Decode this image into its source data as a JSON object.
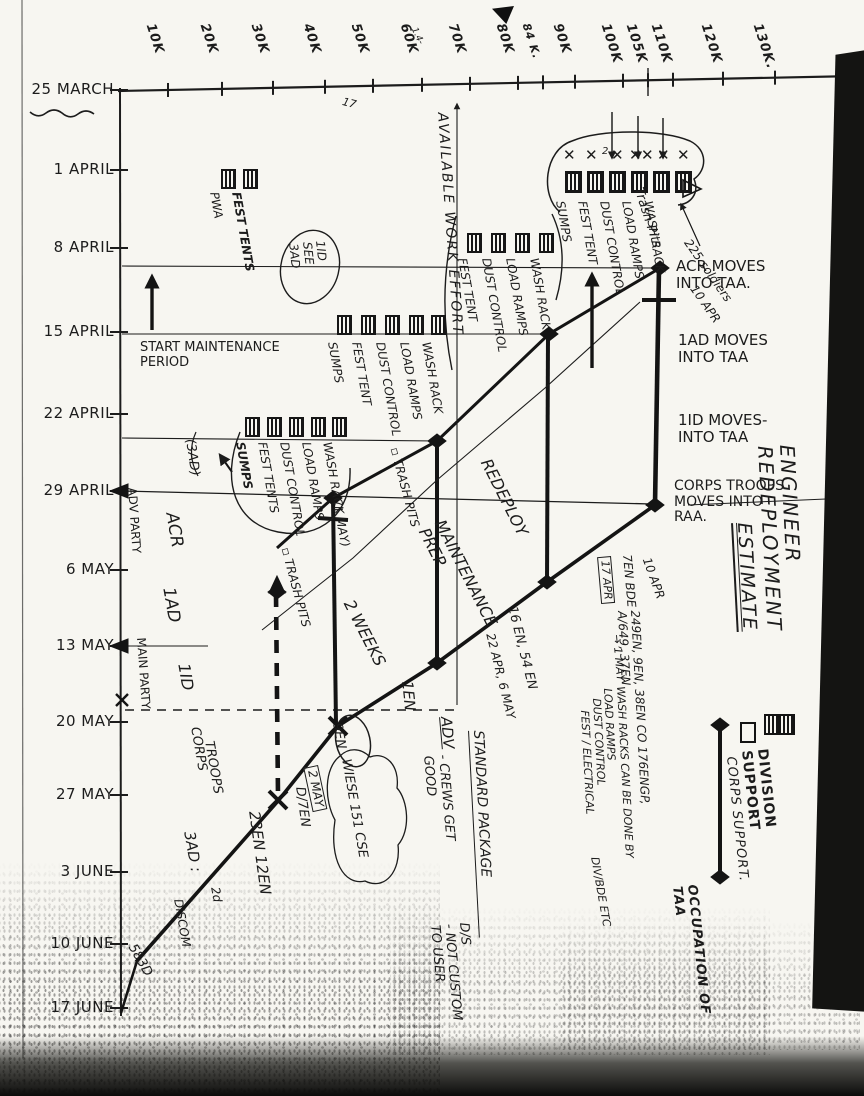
{
  "title": {
    "line1": "ENGINEER REDEPLOYMENT",
    "line2": "ESTIMATE"
  },
  "axes": {
    "date_ticks": [
      "25 MARCH",
      "1 APRIL",
      "8 APRIL",
      "15 APRIL",
      "22 APRIL",
      "29 APRIL",
      "6 MAY",
      "13 MAY",
      "20 MAY",
      "27 MAY",
      "3 JUNE",
      "10 JUNE",
      "17 JUNE"
    ],
    "km_ticks": [
      {
        "t": "10K"
      },
      {
        "t": "20K"
      },
      {
        "t": "30K"
      },
      {
        "t": "40K"
      },
      {
        "t": "50K"
      },
      {
        "t": "60K"
      },
      {
        "t": "70K"
      },
      {
        "t": "80K"
      },
      {
        "t": "84 K.",
        "small": true
      },
      {
        "t": "90K"
      },
      {
        "t": "100K"
      },
      {
        "t": "105K"
      },
      {
        "t": "110K"
      },
      {
        "t": "120K"
      },
      {
        "t": "130K."
      }
    ]
  },
  "legend": {
    "items": [
      {
        "symbol": "division-support-boxes",
        "label": "DIVISION SUPPORT"
      },
      {
        "symbol": "corps-support-box",
        "label": "CORPS SUPPORT."
      },
      {
        "symbol": "occupation-bar",
        "label": "OCCUPATION OF TAA"
      }
    ]
  },
  "annotations": [
    {
      "n": "acr-moves-note",
      "t": "ACR MOVES\nINTO TAA.",
      "x": 676,
      "y": 258,
      "r": 0,
      "fs": 15
    },
    {
      "n": "1ad-moves-note",
      "t": "1AD MOVES\nINTO TAA",
      "x": 678,
      "y": 332,
      "r": 0,
      "fs": 15
    },
    {
      "n": "1id-moves-note",
      "t": "1ID MOVES-\nINTO TAA",
      "x": 678,
      "y": 412,
      "r": 0,
      "fs": 15
    },
    {
      "n": "corps-troops-note",
      "t": "CORPS TROOPS\nMOVES INTO\nRAA.",
      "x": 674,
      "y": 479,
      "r": 0,
      "fs": 14
    },
    {
      "n": "start-maintenance-note",
      "t": "START MAINTENANCE\nPERIOD",
      "x": 140,
      "y": 341,
      "r": 0,
      "fs": 13
    },
    {
      "n": "available-work-effort",
      "t": "AVAILABLE  WORK  EFFORT",
      "x": 449,
      "y": 112,
      "r": 86,
      "fs": 14,
      "i": 1,
      "ls": 2
    },
    {
      "n": "maintenance-prep",
      "t": "MAINTENANCE\nPREP",
      "x": 447,
      "y": 517,
      "r": 63,
      "fs": 16,
      "i": 1
    },
    {
      "n": "redeploy",
      "t": "REDEPLOY",
      "x": 493,
      "y": 456,
      "r": 63,
      "fs": 16,
      "i": 1
    },
    {
      "n": "two-weeks",
      "t": "2 WEEKS",
      "x": 356,
      "y": 597,
      "r": 63,
      "fs": 16,
      "i": 1
    },
    {
      "n": "adv-party",
      "t": "ADV PARTY",
      "x": 138,
      "y": 487,
      "r": 86,
      "fs": 12
    },
    {
      "n": "main-party",
      "t": "MAIN PARTY",
      "x": 147,
      "y": 637,
      "r": 86,
      "fs": 12
    },
    {
      "n": "col-acr",
      "t": "ACR",
      "x": 180,
      "y": 511,
      "r": 80,
      "fs": 17,
      "i": 1
    },
    {
      "n": "col-1ad",
      "t": "1AD",
      "x": 177,
      "y": 586,
      "r": 80,
      "fs": 17,
      "i": 1
    },
    {
      "n": "col-1id",
      "t": "1ID",
      "x": 192,
      "y": 662,
      "r": 80,
      "fs": 16,
      "i": 1
    },
    {
      "n": "col-corps",
      "t": "CORPS",
      "x": 201,
      "y": 726,
      "r": 80,
      "fs": 13,
      "i": 1
    },
    {
      "n": "col-troops",
      "t": "TROOPS",
      "x": 215,
      "y": 740,
      "r": 80,
      "fs": 13,
      "i": 1
    },
    {
      "n": "col-3ad",
      "t": "3AD :",
      "x": 197,
      "y": 830,
      "r": 80,
      "fs": 15,
      "i": 1
    },
    {
      "n": "col-2d",
      "t": "2d",
      "x": 221,
      "y": 886,
      "r": 80,
      "fs": 12,
      "i": 1
    },
    {
      "n": "col-discom",
      "t": "DISCOM",
      "x": 184,
      "y": 898,
      "r": 80,
      "fs": 12,
      "i": 1
    },
    {
      "n": "units-23en-12en",
      "t": "23EN 12EN",
      "x": 262,
      "y": 810,
      "r": 82,
      "fs": 15,
      "i": 1
    },
    {
      "n": "unit-d-7en",
      "t": "D/7EN",
      "x": 306,
      "y": 786,
      "r": 82,
      "fs": 13,
      "i": 1
    },
    {
      "n": "unit-583d",
      "t": "583D",
      "x": 137,
      "y": 942,
      "r": 60,
      "fs": 13,
      "i": 1
    },
    {
      "n": "bar-label-1en",
      "t": "1EN",
      "x": 415,
      "y": 680,
      "r": 84,
      "fs": 15,
      "i": 1
    },
    {
      "n": "bar-label-16-54en",
      "t": "16 EN, 54 EN",
      "x": 518,
      "y": 605,
      "r": 76,
      "fs": 13,
      "i": 1
    },
    {
      "n": "bar-dates-16-54en",
      "t": "22 APR, 6 MAY",
      "x": 496,
      "y": 632,
      "r": 76,
      "fs": 12,
      "i": 1
    },
    {
      "n": "adv-label",
      "t": "ADV",
      "x": 454,
      "y": 716,
      "r": 85,
      "fs": 15,
      "u": 1,
      "i": 1
    },
    {
      "n": "crews-note",
      "t": "- CREWS GET\nGOOD",
      "x": 449,
      "y": 754,
      "r": 85,
      "fs": 13,
      "i": 1
    },
    {
      "n": "standard-package",
      "t": "STANDARD PACKAGE",
      "x": 485,
      "y": 730,
      "r": 87,
      "fs": 14,
      "u": 2,
      "i": 1
    },
    {
      "n": "ds-note",
      "t": "D/S\n- NOT CUSTOM\nTO USER",
      "x": 470,
      "y": 922,
      "r": 85,
      "fs": 13,
      "i": 1
    },
    {
      "n": "note-10apr-taa",
      "t": "10 APR",
      "x": 698,
      "y": 283,
      "r": 55,
      "fs": 12,
      "i": 1
    },
    {
      "n": "note-10apr-corps",
      "t": "10 APR",
      "x": 652,
      "y": 556,
      "r": 70,
      "fs": 12,
      "i": 1
    },
    {
      "n": "note-7en-bde",
      "t": "7EN BDE",
      "x": 633,
      "y": 554,
      "r": 85,
      "fs": 12,
      "i": 1
    },
    {
      "n": "note-17apr",
      "t": "17 APR",
      "x": 611,
      "y": 556,
      "r": 85,
      "fs": 11,
      "box": 1,
      "i": 1
    },
    {
      "n": "note-to-1may",
      "t": "→ 1 MAY",
      "x": 622,
      "y": 634,
      "r": 85,
      "fs": 11,
      "i": 1
    },
    {
      "n": "note-corps-units",
      "t": "249EN, 9EN, 38EN CO 176ENGP, A/649, 37EN",
      "x": 641,
      "y": 610,
      "r": 87,
      "fs": 12,
      "i": 1
    },
    {
      "n": "note-wash-racks-by",
      "t": "WASH RACKS    CAN BE DONE BY",
      "x": 626,
      "y": 686,
      "r": 87,
      "fs": 11,
      "i": 1
    },
    {
      "n": "note-load-ramps",
      "t": "LOAD RAMPS",
      "x": 613,
      "y": 688,
      "r": 87,
      "fs": 11,
      "i": 1
    },
    {
      "n": "note-dust-control",
      "t": "DUST CONTROL",
      "x": 602,
      "y": 698,
      "r": 87,
      "fs": 11,
      "i": 1
    },
    {
      "n": "note-fest-electrical",
      "t": "FEST / ELECTRICAL",
      "x": 590,
      "y": 710,
      "r": 87,
      "fs": 11,
      "i": 1
    },
    {
      "n": "note-div-bde",
      "t": "DIV/BDE ETC",
      "x": 600,
      "y": 856,
      "r": 80,
      "fs": 11,
      "i": 1
    },
    {
      "n": "note-1may",
      "t": "(1 MAY)",
      "x": 342,
      "y": 500,
      "r": 78,
      "fs": 12,
      "i": 1
    },
    {
      "n": "trash-pits-1",
      "t": "▫ TRASH PITS",
      "x": 291,
      "y": 546,
      "r": 75,
      "fs": 12,
      "i": 1
    },
    {
      "n": "trash-pits-2",
      "t": "▫ TRASH PITS",
      "x": 400,
      "y": 446,
      "r": 75,
      "fs": 12,
      "i": 1
    },
    {
      "n": "trash-pits-taa",
      "t": "Trash Pits",
      "x": 644,
      "y": 186,
      "r": 72,
      "fs": 13,
      "i": 1
    },
    {
      "n": "note-225",
      "t": "225 soldiers",
      "x": 692,
      "y": 237,
      "r": 55,
      "fs": 12,
      "i": 1
    },
    {
      "n": "note-9en",
      "t": "9EN",
      "x": 343,
      "y": 722,
      "r": 80,
      "fs": 13,
      "i": 1
    },
    {
      "n": "note-wiese",
      "t": "WIESE 151 CSE",
      "x": 352,
      "y": 758,
      "r": 80,
      "fs": 13,
      "i": 1
    },
    {
      "n": "note-2may",
      "t": "2 MAY",
      "x": 318,
      "y": 765,
      "r": 78,
      "fs": 12,
      "box": 1,
      "i": 1
    },
    {
      "n": "note-3ad",
      "t": "(3AD)",
      "x": 196,
      "y": 438,
      "r": 82,
      "fs": 13,
      "i": 1
    },
    {
      "n": "note-1id-see-3ad",
      "t": "1ID\nSEE\n3AD",
      "x": 326,
      "y": 240,
      "r": 84,
      "fs": 12,
      "i": 1
    },
    {
      "n": "stray-17",
      "t": "17",
      "x": 344,
      "y": 96,
      "r": 15,
      "fs": 11,
      "i": 1
    },
    {
      "n": "stray-1-4",
      "t": "1.4-",
      "x": 418,
      "y": 26,
      "r": 65,
      "fs": 9,
      "i": 1
    },
    {
      "n": "stray-2",
      "t": "2",
      "x": 602,
      "y": 146,
      "r": 0,
      "fs": 10,
      "i": 1
    }
  ],
  "clusters": [
    {
      "n": "facilities-1apr-pwa",
      "boxY": 169,
      "labelY": 191,
      "boxes": [
        221,
        243
      ],
      "labels": [
        {
          "t": "PWA",
          "x": 220
        },
        {
          "t": "FEST TENTS",
          "x": 242,
          "b": 1
        }
      ]
    },
    {
      "n": "facilities-8apr",
      "boxY": 233,
      "labelY": 257,
      "boxes": [
        467,
        491,
        515,
        539
      ],
      "labels": [
        {
          "t": "FEST TENT",
          "x": 468
        },
        {
          "t": "DUST CONTROL",
          "x": 492
        },
        {
          "t": "LOAD RAMPS",
          "x": 516
        },
        {
          "t": "WASH RACK",
          "x": 540
        }
      ]
    },
    {
      "n": "facilities-15apr",
      "boxY": 315,
      "labelY": 341,
      "boxes": [
        337,
        361,
        385,
        409,
        431
      ],
      "labels": [
        {
          "t": "SUMPS",
          "x": 338
        },
        {
          "t": "FEST TENT",
          "x": 362
        },
        {
          "t": "DUST CONTROL",
          "x": 386
        },
        {
          "t": "LOAD RAMPS",
          "x": 410
        },
        {
          "t": "WASH RACK",
          "x": 432
        }
      ]
    },
    {
      "n": "facilities-22apr",
      "boxY": 417,
      "labelY": 441,
      "boxes": [
        245,
        267,
        289,
        311,
        332
      ],
      "labels": [
        {
          "t": "SUMPS",
          "x": 246,
          "b": 1
        },
        {
          "t": "FEST TENTS",
          "x": 268
        },
        {
          "t": "DUST CONTROL",
          "x": 290
        },
        {
          "t": "LOAD RAMPS",
          "x": 312
        },
        {
          "t": "WASH RACK",
          "x": 333
        }
      ]
    },
    {
      "n": "facilities-taa-1apr",
      "boxY": 171,
      "labelY": 200,
      "bold": true,
      "boxes": [
        565,
        587,
        609,
        631,
        653,
        675
      ],
      "xmarks": [
        563,
        585,
        611,
        629,
        641,
        657,
        677
      ],
      "labels": [
        {
          "t": "SUMPS",
          "x": 566
        },
        {
          "t": "FEST TENT",
          "x": 588
        },
        {
          "t": "DUST CONTROL",
          "x": 610
        },
        {
          "t": "LOAD RAMPS",
          "x": 632
        },
        {
          "t": "WASH RACK",
          "x": 654
        }
      ]
    }
  ],
  "chart_data": {
    "type": "line",
    "title": "ENGINEER REDEPLOYMENT ESTIMATE",
    "xlabel": "Route distance (km markers)",
    "ylabel": "Date (weekly rows)",
    "x_ticks": [
      "10K",
      "20K",
      "30K",
      "40K",
      "50K",
      "60K",
      "70K",
      "80K",
      "84K",
      "90K",
      "100K",
      "105K",
      "110K",
      "120K",
      "130K"
    ],
    "y_ticks": [
      "25 MARCH",
      "1 APRIL",
      "8 APRIL",
      "15 APRIL",
      "22 APRIL",
      "29 APRIL",
      "6 MAY",
      "13 MAY",
      "20 MAY",
      "27 MAY",
      "3 JUNE",
      "10 JUNE",
      "17 JUNE"
    ],
    "grid": "partial hand-drawn weekly lines",
    "legend_position": "right, rotated",
    "series": [
      {
        "name": "maintenance prep start (upper thick line)",
        "points": [
          {
            "km": 31,
            "date": "2 MAY"
          },
          {
            "km": 42,
            "date": "29 APRIL"
          },
          {
            "km": 63,
            "date": "22 APRIL"
          },
          {
            "km": 85,
            "date": "15 APRIL"
          },
          {
            "km": 105,
            "date": "8 APRIL"
          }
        ]
      },
      {
        "name": "redeploy (lower thick line)",
        "points": [
          {
            "km": 4,
            "date": "10 JUNE"
          },
          {
            "km": 32,
            "date": "27 MAY"
          },
          {
            "km": 43,
            "date": "20 MAY"
          },
          {
            "km": 63,
            "date": "13 MAY"
          },
          {
            "km": 85,
            "date": "6 MAY"
          },
          {
            "km": 105,
            "date": "29 APRIL"
          }
        ]
      }
    ],
    "occupation_bars": [
      {
        "km": 105,
        "from": "8 APRIL",
        "to": "29 APRIL",
        "events": [
          "ACR MOVES INTO TAA (8 APR)",
          "1AD MOVES INTO TAA (15 APR)",
          "1ID MOVES INTO TAA (22 APR)",
          "CORPS TROOPS MOVES INTO RAA (29 APR)"
        ]
      },
      {
        "km": 85,
        "from": "15 APRIL",
        "to": "6 MAY",
        "units": "16 EN, 54 EN",
        "dates": "22 APR, 6 MAY"
      },
      {
        "km": 63,
        "from": "22 APRIL",
        "to": "13 MAY",
        "units": "1EN"
      },
      {
        "km": 42,
        "from": "29 APRIL",
        "to": "20 MAY",
        "units": "9EN / D/7EN",
        "note": "2 MAY",
        "style": "dashed companion bar"
      }
    ],
    "band_labels": [
      "MAINTENANCE PREP",
      "2 WEEKS",
      "REDEPLOY"
    ],
    "facility_types": [
      "WASH RACK",
      "LOAD RAMPS",
      "DUST CONTROL",
      "FEST TENTS",
      "SUMPS",
      "TRASH PITS",
      "PWA"
    ]
  }
}
